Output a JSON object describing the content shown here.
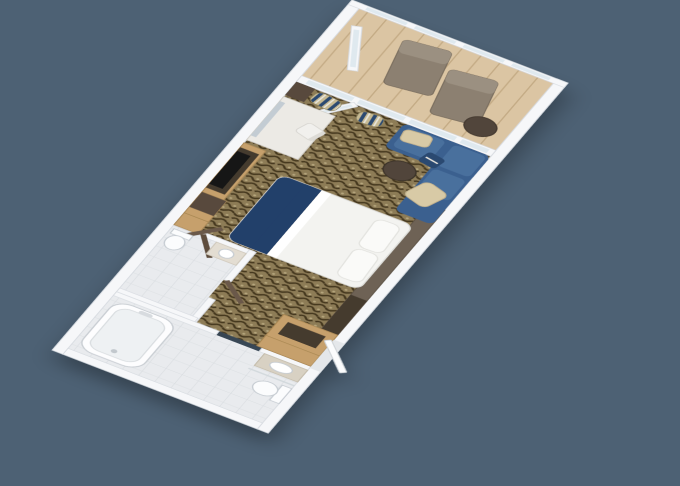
{
  "scene": {
    "type": "3d-floorplan-render",
    "subject": "Isometric 3D floor plan of a balcony stateroom, rotated diagonally on a slate-blue background; no visible text",
    "view_rotation": "long axis runs from lower-left entry to upper-right balcony"
  },
  "colors": {
    "background": "#4d6174",
    "wall": "#f6f7f9",
    "wall-shade": "#d8dce1",
    "glass": "#dfe9ef",
    "deck-base": "#dbc5a3",
    "deck-line": "#c4ab85",
    "carpet-base": "#8d7b56",
    "carpet-dark": "#44371f",
    "carpet-light": "#b5a67d",
    "tile-base": "#e9ebee",
    "tile-line": "#d7dbdf",
    "sofa-blue": "#3b618f",
    "sofa-blue-light": "#4a6f9d",
    "bed-navy": "#223f6a",
    "bed-white": "#f3f3f0",
    "wood-light": "#c6a06c",
    "wood-dark": "#584a3c",
    "wood-espresso": "#453a2e",
    "wood-gray": "#6e6254",
    "lounger": "#8c8071",
    "lounger-light": "#9b9081",
    "table-dark": "#51453a",
    "cream": "#d8caa6",
    "curtain-navy": "#2b4a71",
    "curtain-tan": "#c7ba93",
    "curtain-white": "#e9e7e0",
    "fixture-white": "#fbfcfd",
    "fixture-line": "#c5cbd1",
    "counter-tan": "#d8d1c3",
    "tv-black": "#131419"
  },
  "rooms": [
    {
      "name": "balcony",
      "furniture": [
        "lounge chair",
        "lounge chair",
        "round side table",
        "glass railing",
        "open glass door"
      ]
    },
    {
      "name": "main cabin",
      "furniture": [
        "queen bed with navy runner and two pillows",
        "blue L-shaped sofa with cream pillows",
        "round dark side table",
        "vanity desk with mirror and white chair",
        "TV in dark wood panel",
        "wardrobe with open doors",
        "striped curtains",
        "headboard ledge"
      ]
    },
    {
      "name": "second washroom",
      "furniture": [
        "toilet",
        "sink counter",
        "open door"
      ]
    },
    {
      "name": "main bathroom",
      "furniture": [
        "bathtub",
        "toilet",
        "sink counter"
      ]
    },
    {
      "name": "entry corridor",
      "furniture": [
        "minibar cabinet",
        "entry door"
      ]
    }
  ]
}
